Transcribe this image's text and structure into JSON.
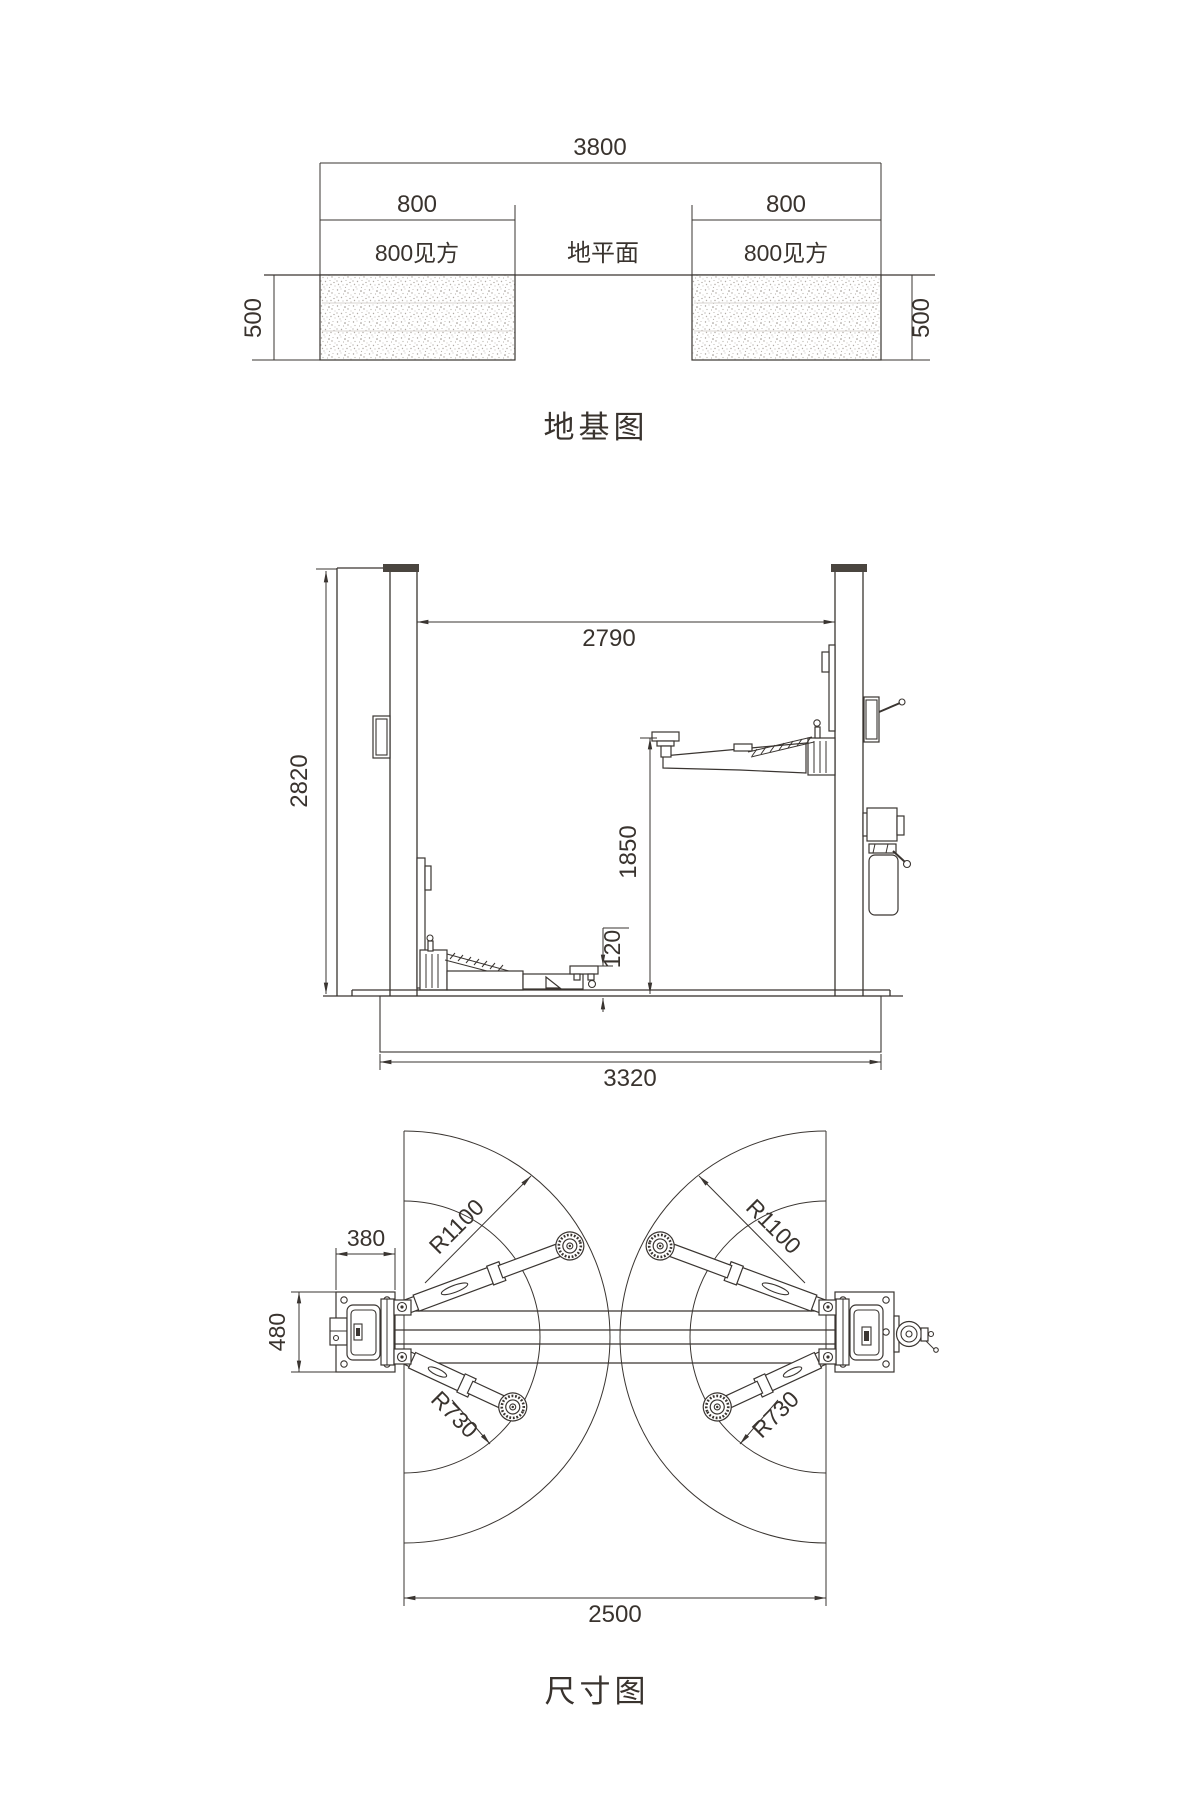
{
  "page": {
    "background": "#ffffff",
    "ink": "#3a3531"
  },
  "foundation_diagram": {
    "title": "地基图",
    "overall_width": "3800",
    "left_block_width": "800",
    "right_block_width": "800",
    "left_block_label": "800见方",
    "right_block_label": "800见方",
    "ground_label": "地平面",
    "left_depth": "500",
    "right_depth": "500"
  },
  "front_view": {
    "column_height": "2820",
    "inner_clearance": "2790",
    "max_lift_height": "1850",
    "min_pad_height": "120",
    "base_length": "3320"
  },
  "top_view": {
    "title": "尺寸图",
    "column_base_depth": "380",
    "column_base_width": "480",
    "left_long_arm_radius": "R1100",
    "right_long_arm_radius": "R1100",
    "left_short_arm_radius": "R730",
    "right_short_arm_radius": "R730",
    "drive_through_span": "2500"
  }
}
